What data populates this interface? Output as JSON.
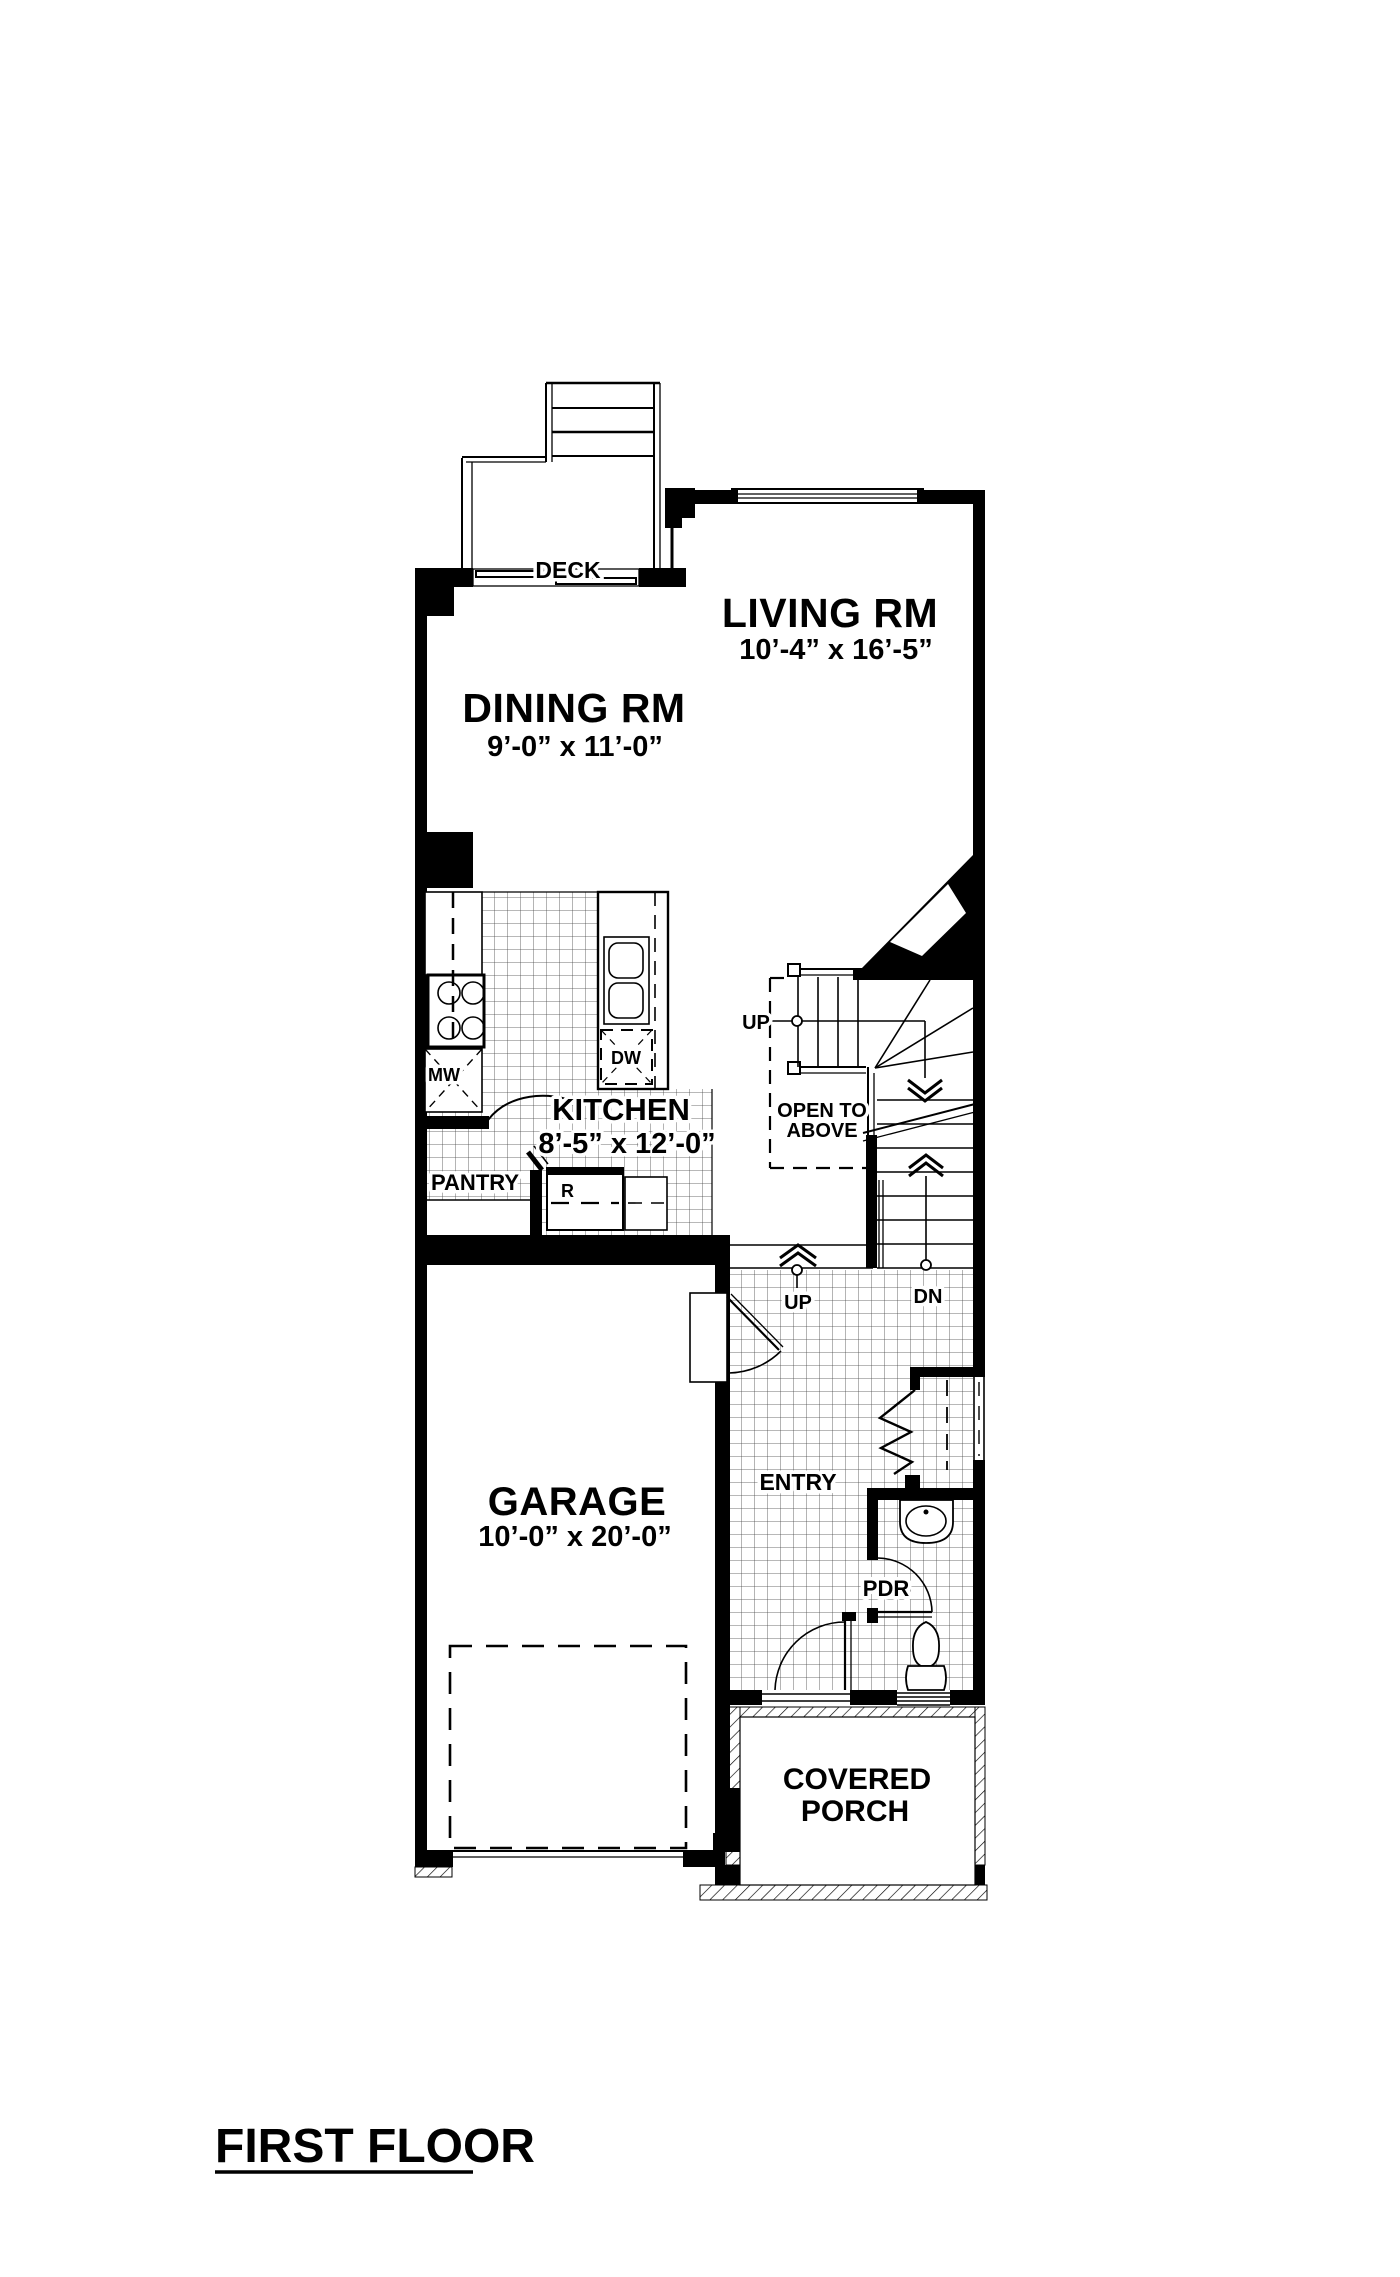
{
  "title": {
    "label": "FIRST FLOOR"
  },
  "plan": {
    "rooms": {
      "deck": {
        "name": "DECK"
      },
      "living": {
        "name": "LIVING RM",
        "dims": "10’-4” x 16’-5”"
      },
      "dining": {
        "name": "DINING RM",
        "dims": "9’-0” x 11’-0”"
      },
      "kitchen": {
        "name": "KITCHEN",
        "dims": "8’-5” x 12’-0”"
      },
      "garage": {
        "name": "GARAGE",
        "dims": "10’-0” x 20’-0”"
      },
      "entry": {
        "name": "ENTRY"
      },
      "pdr": {
        "name": "PDR"
      },
      "pantry": {
        "name": "PANTRY"
      },
      "porch": {
        "line1": "COVERED",
        "line2": "PORCH"
      },
      "open_to_above": {
        "line1": "OPEN TO",
        "line2": "ABOVE"
      }
    },
    "labels": {
      "up_stairs": "UP",
      "up_entry": "UP",
      "down": "DN",
      "microwave": "MW",
      "dishwasher": "DW",
      "refrigerator": "R"
    },
    "colors": {
      "ink": "#000000",
      "paper": "#ffffff"
    }
  }
}
